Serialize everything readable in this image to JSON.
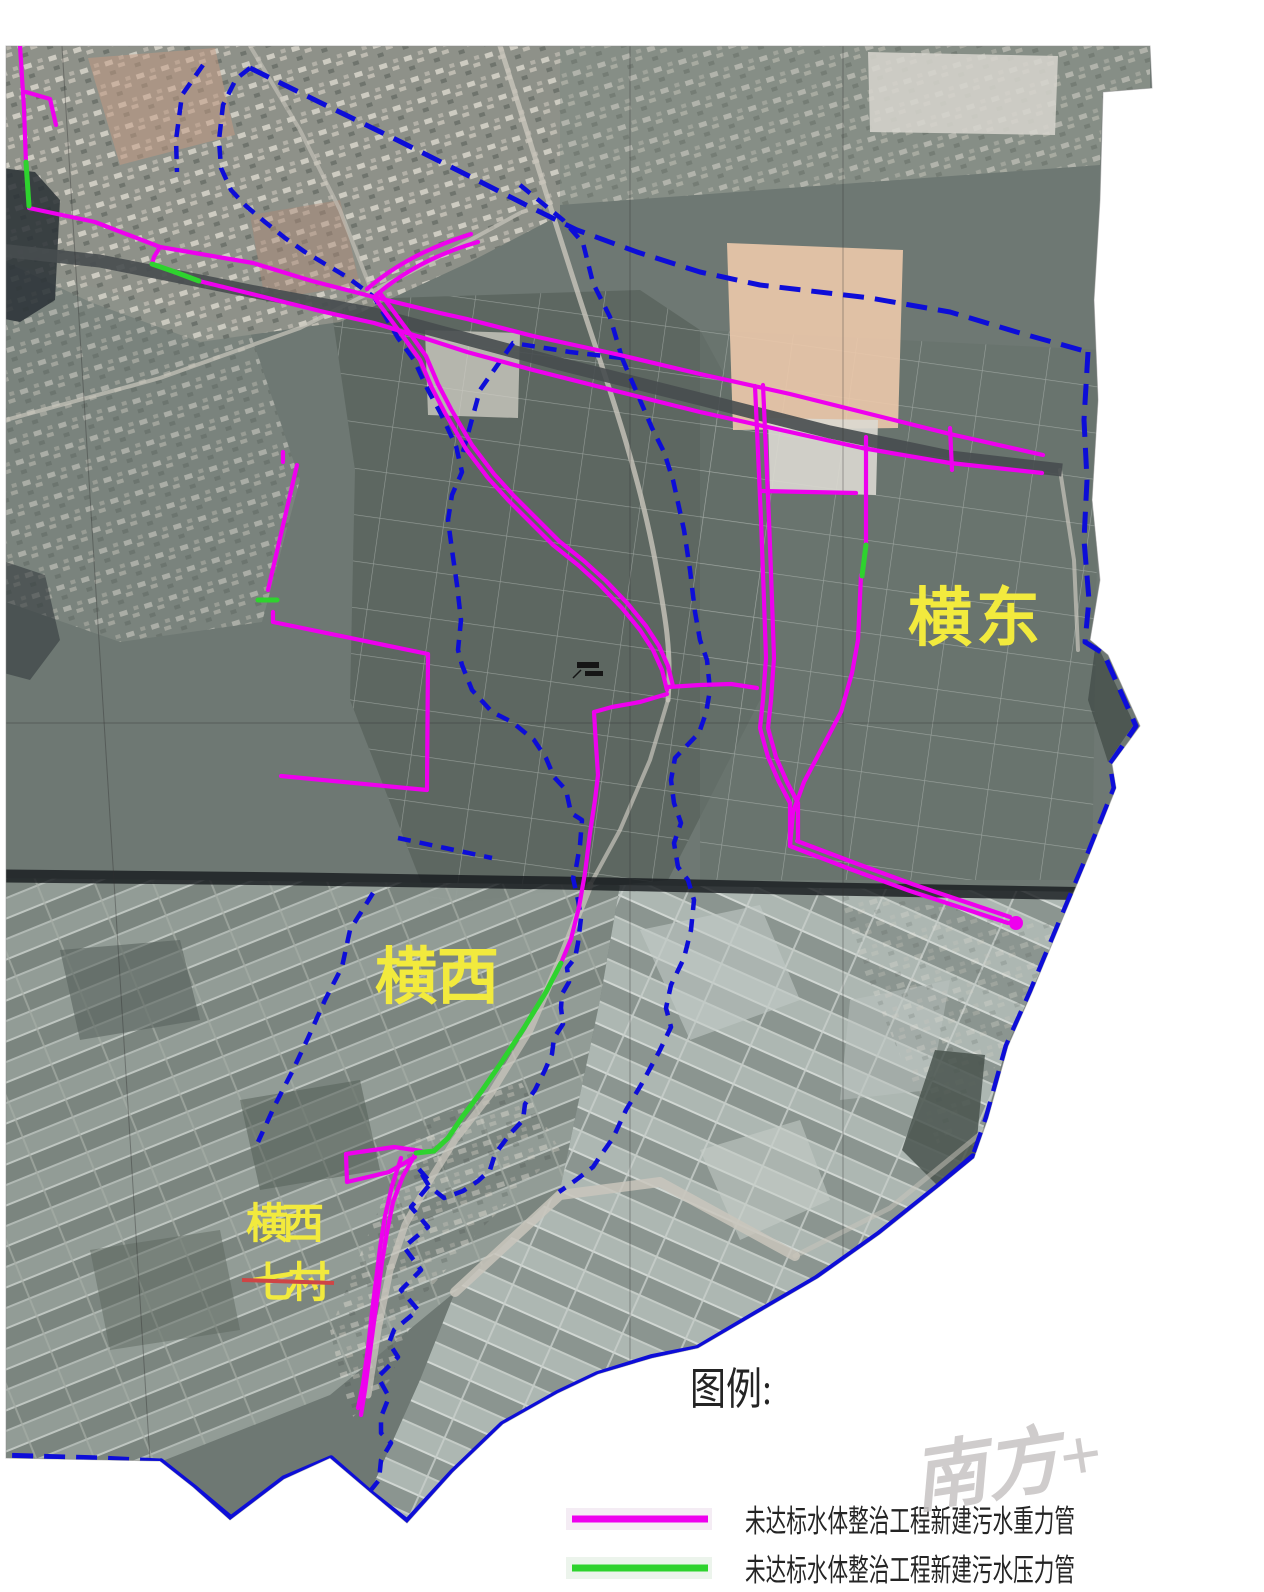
{
  "map": {
    "region_labels": [
      {
        "id": "hengdong",
        "text": "横东"
      },
      {
        "id": "hengxi",
        "text": "横西"
      },
      {
        "id": "hengxi_qicun_line1",
        "text": "横西"
      },
      {
        "id": "hengxi_qicun_line2",
        "text": "七村"
      }
    ]
  },
  "legend": {
    "title": "图例:",
    "items": [
      {
        "id": "gravity_pipe",
        "label": "未达标水体整治工程新建污水重力管",
        "color": "#ee00ee"
      },
      {
        "id": "pressure_pipe",
        "label": "未达标水体整治工程新建污水压力管",
        "color": "#2ed32e"
      }
    ]
  },
  "watermark": {
    "text": "南方+"
  },
  "colors": {
    "boundary_blue": "#0d0dd8",
    "pipe_gravity_magenta": "#ee00ee",
    "pipe_pressure_green": "#2ed32e",
    "label_yellow": "#f2ea3d",
    "strike_red": "#cf4545"
  }
}
